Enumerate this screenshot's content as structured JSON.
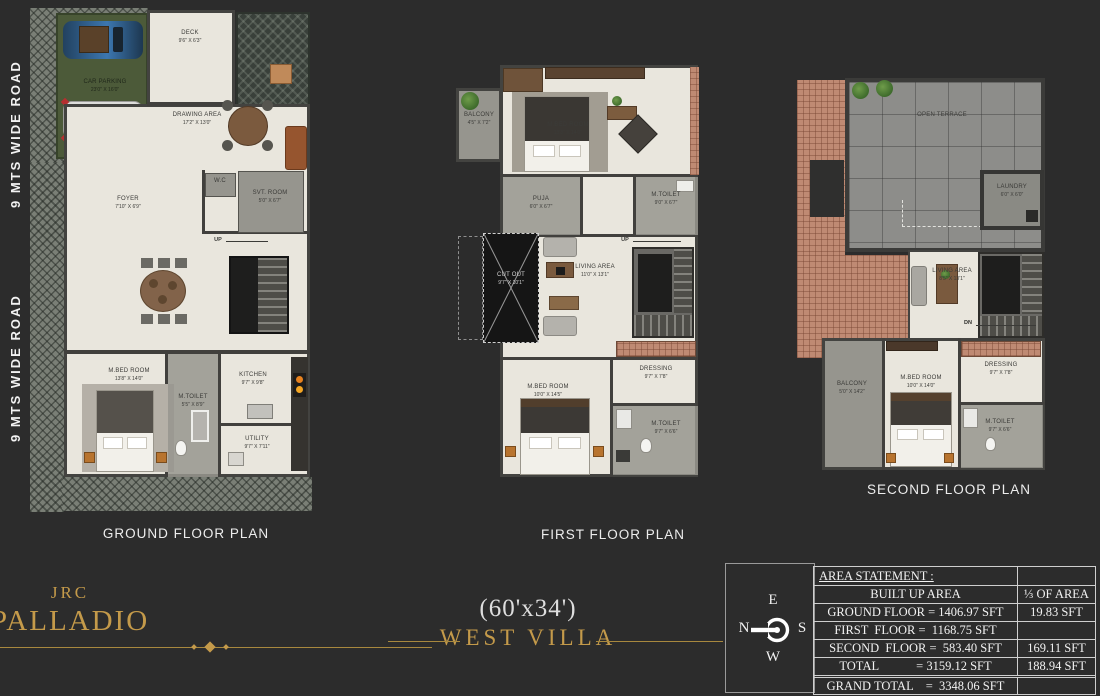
{
  "colors": {
    "background": "#2c2c2c",
    "accent_gold": "#c49a4a",
    "floor_cream": "#e9e6dd"
  },
  "roads": {
    "top": "9 MTS WIDE ROAD",
    "bottom": "9 MTS WIDE ROAD"
  },
  "ground": {
    "title": "GROUND FLOOR PLAN",
    "car": {
      "name": "CAR PARKING",
      "dims": "23'0\" X 16'0\""
    },
    "deck": {
      "name": "DECK",
      "dims": "9'6\" X 6'3\""
    },
    "drawing": {
      "name": "DRAWING AREA",
      "dims": "17'2\" X 13'0\""
    },
    "foyer": {
      "name": "FOYER",
      "dims": "7'10\" X 6'9\""
    },
    "wc": {
      "name": "W.C"
    },
    "svt": {
      "name": "SVT. ROOM",
      "dims": "5'0\" X 6'7\""
    },
    "up": "UP",
    "mbed": {
      "name": "M.BED ROOM",
      "dims": "13'8\" X 14'0\""
    },
    "mtoilet": {
      "name": "M.TOILET",
      "dims": "5'5\" X 8'9\""
    },
    "kitchen": {
      "name": "KITCHEN",
      "dims": "9'7\" X 9'8\""
    },
    "utility": {
      "name": "UTILITY",
      "dims": "9'7\" X 7'11\""
    }
  },
  "first": {
    "title": "FIRST FLOOR PLAN",
    "balcony": {
      "name": "BALCONY",
      "dims": "4'5\" X 7'2\""
    },
    "mbed_top": {
      "name": "M.BED ROOM",
      "dims": "13'8\" X 14'0\""
    },
    "puja": {
      "name": "PUJA",
      "dims": "6'0\" X 6'7\""
    },
    "mtoilet_top": {
      "name": "M.TOILET",
      "dims": "9'0\" X 6'7\""
    },
    "cutout": {
      "name": "CUT OUT",
      "dims": "9'7\" X 10'1\""
    },
    "living": {
      "name": "LIVING AREA",
      "dims": "11'0\" X 13'1\""
    },
    "up": "UP",
    "dressing": {
      "name": "DRESSING",
      "dims": "9'7\" X 7'8\""
    },
    "mbed_bottom": {
      "name": "M.BED ROOM",
      "dims": "10'0\" X 14'5\""
    },
    "mtoilet_bottom": {
      "name": "M.TOILET",
      "dims": "9'7\" X 6'6\""
    }
  },
  "second": {
    "title": "SECOND  FLOOR PLAN",
    "terrace": {
      "name": "OPEN TERRACE"
    },
    "laundry": {
      "name": "LAUNDRY",
      "dims": "6'0\" X 6'0\""
    },
    "living": {
      "name": "LIVING AREA",
      "dims": "8'5\" X 13'1\""
    },
    "dn": "DN",
    "dressing": {
      "name": "DRESSING",
      "dims": "9'7\" X 7'8\""
    },
    "balcony": {
      "name": "BALCONY",
      "dims": "5'0\" X 14'2\""
    },
    "mbed": {
      "name": "M.BED ROOM",
      "dims": "10'0\" X 14'0\""
    },
    "mtoilet": {
      "name": "M.TOILET",
      "dims": "9'7\" X 6'6\""
    }
  },
  "footer": {
    "brand_top": "JRC",
    "brand_name": "PALLADIO",
    "plot_size": "(60'x34')",
    "villa": "WEST VILLA",
    "compass": {
      "e": "E",
      "n": "N",
      "s": "S",
      "w": "W"
    },
    "table": {
      "title": "AREA STATEMENT :",
      "built_up": "BUILT UP AREA",
      "col2_header": "⅓ OF AREA",
      "rows": [
        {
          "text": "GROUND FLOOR = 1406.97 SFT",
          "col2": "19.83 SFT"
        },
        {
          "text": "FIRST  FLOOR =  1168.75 SFT",
          "col2": ""
        },
        {
          "text": "SECOND  FLOOR =  583.40 SFT",
          "col2": "169.11 SFT"
        },
        {
          "text": "TOTAL            = 3159.12 SFT",
          "col2": "188.94 SFT"
        }
      ],
      "grand": {
        "text": "GRAND TOTAL    =  3348.06 SFT",
        "col2": ""
      }
    }
  }
}
